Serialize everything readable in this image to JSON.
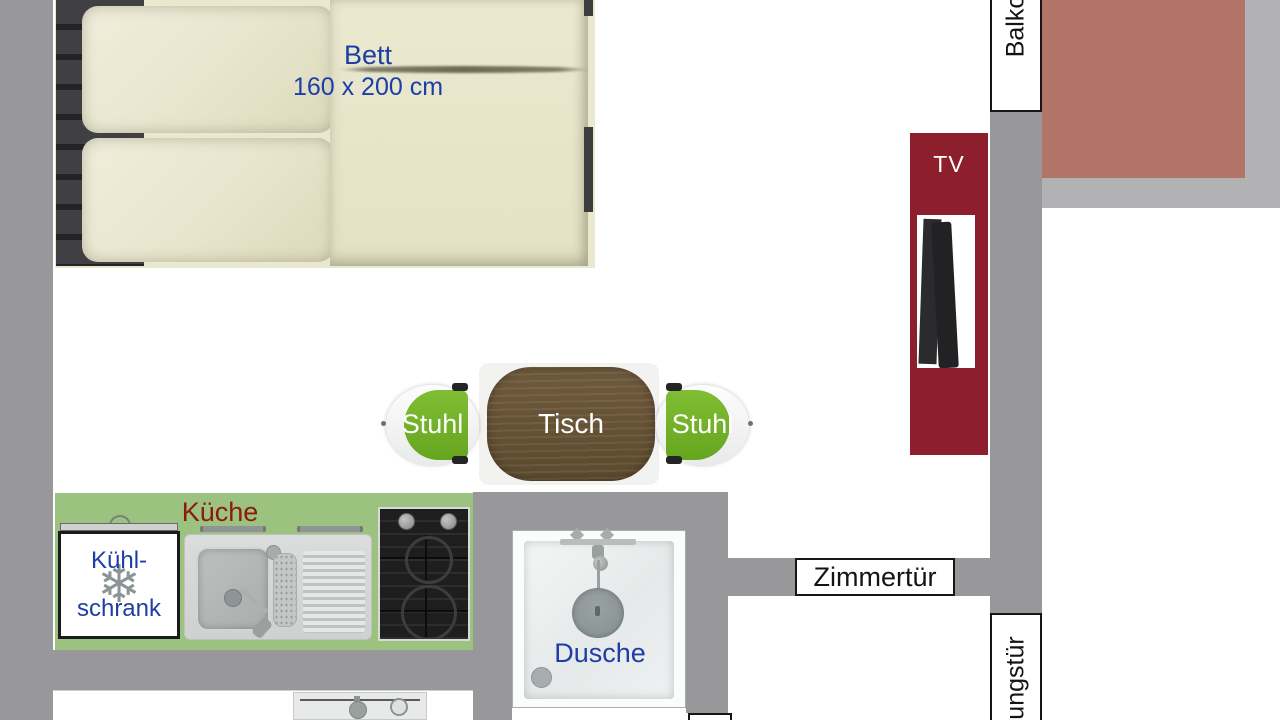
{
  "plan_title": "apartment floor plan",
  "colors": {
    "wall_gray": "#98989b",
    "railing_light_gray": "#b2b2b5",
    "balcony_floor": "#b17467",
    "kitchen_green": "#9cc27f",
    "chair_green": "#72b62a",
    "tv_panel_red": "#8c1f2b",
    "label_blue": "#1d3ea6",
    "kueche_red": "#8c1a0f",
    "table_wood": "#645033",
    "bed_cream": "#eae8cf"
  },
  "bed": {
    "label_line1": "Bett",
    "label_line2": "160 x 200 cm"
  },
  "dining": {
    "table_label": "Tisch",
    "chair_left_label": "Stuhl",
    "chair_right_label": "Stuhl"
  },
  "kitchen": {
    "title": "Küche",
    "fridge_line1": "Kühl-",
    "fridge_line2": "schrank",
    "snowflake_icon": "❄"
  },
  "bathroom": {
    "shower_label": "Dusche"
  },
  "tv": {
    "label": "TV"
  },
  "doors": {
    "room_door": "Zimmertür",
    "balcony_door_partial": "Balko",
    "apartment_door_partial": "ungstür"
  }
}
